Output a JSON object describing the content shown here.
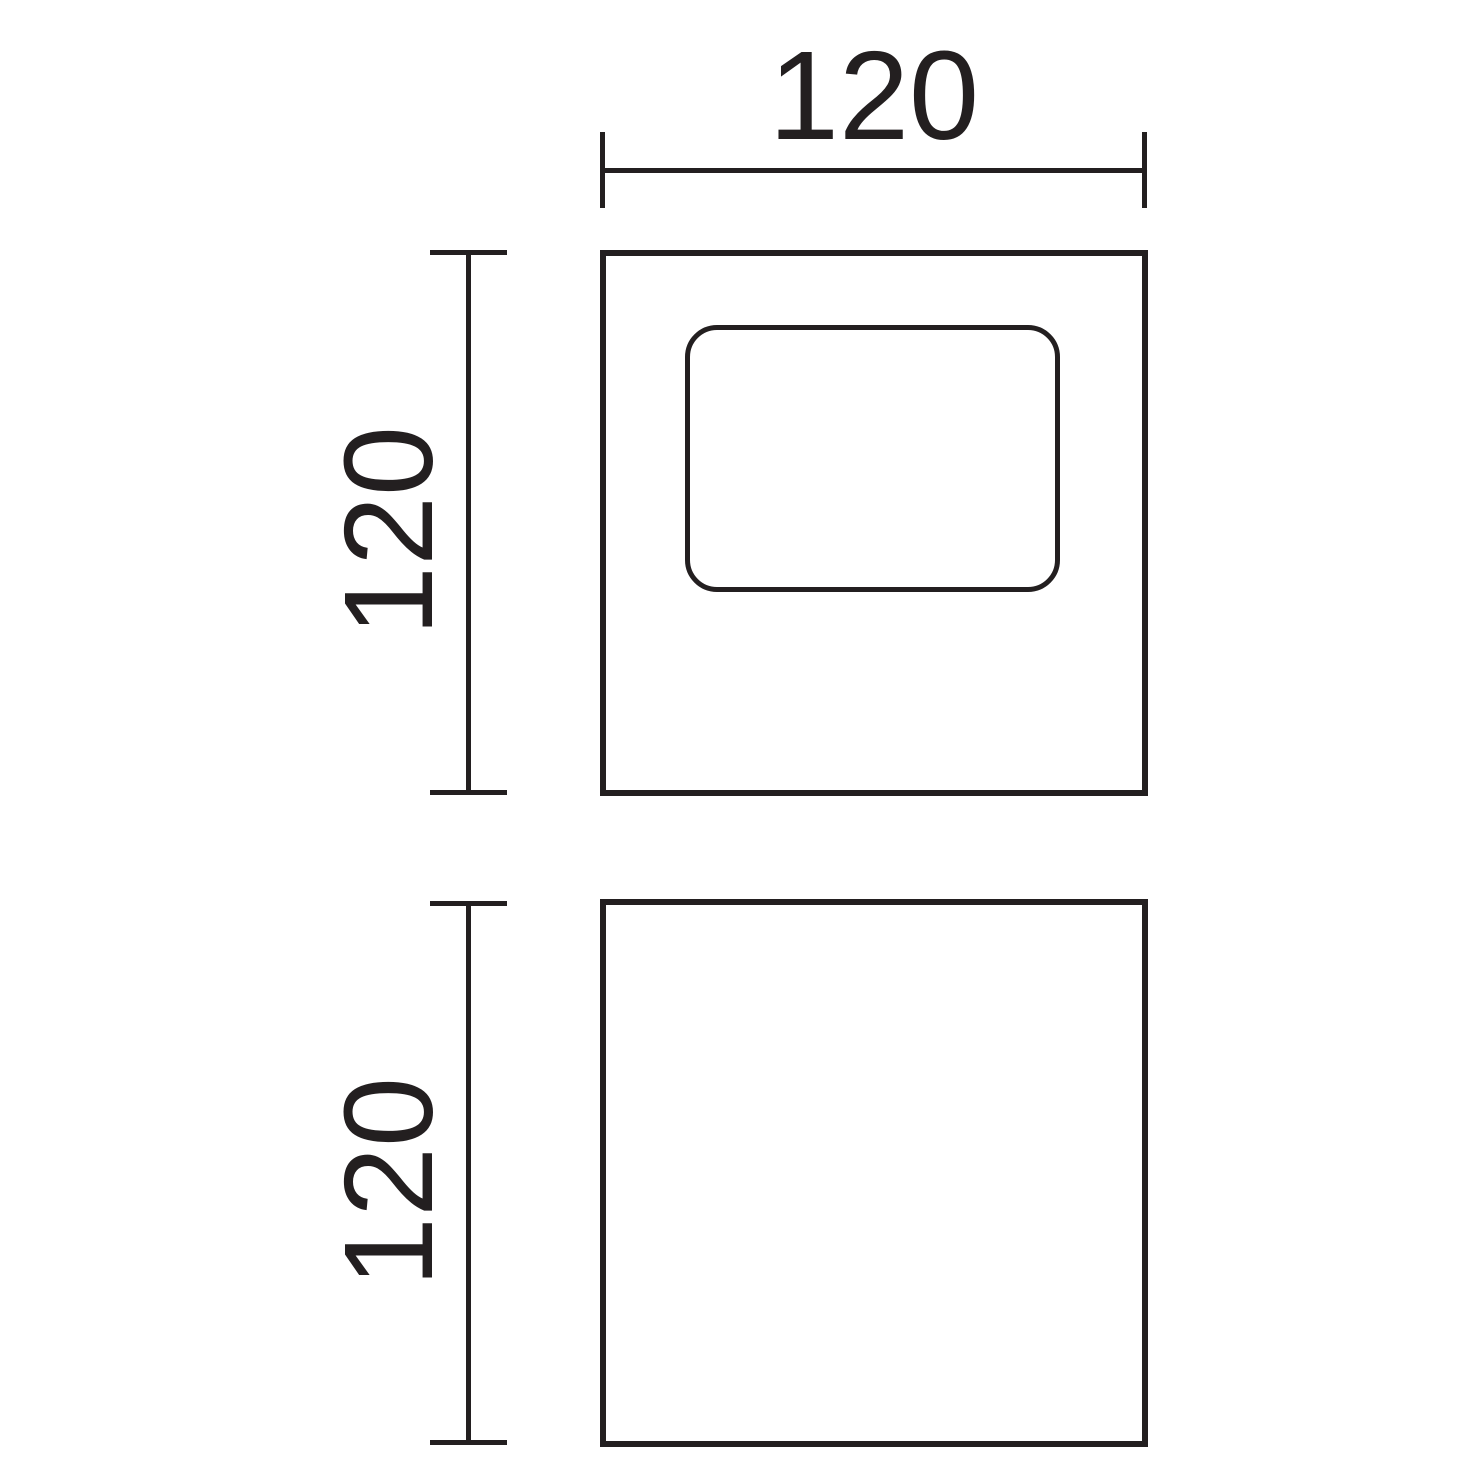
{
  "page": {
    "background": "#ffffff"
  },
  "drawing": {
    "type": "technical-dimension-drawing",
    "line_color": "#231f20",
    "views": [
      {
        "id": "front-view",
        "description": "square face with rounded-rectangle window"
      },
      {
        "id": "side-view",
        "description": "plain square face"
      }
    ],
    "dimensions": {
      "top_width": {
        "label": "120"
      },
      "front_height": {
        "label": "120"
      },
      "side_height": {
        "label": "120"
      }
    }
  }
}
